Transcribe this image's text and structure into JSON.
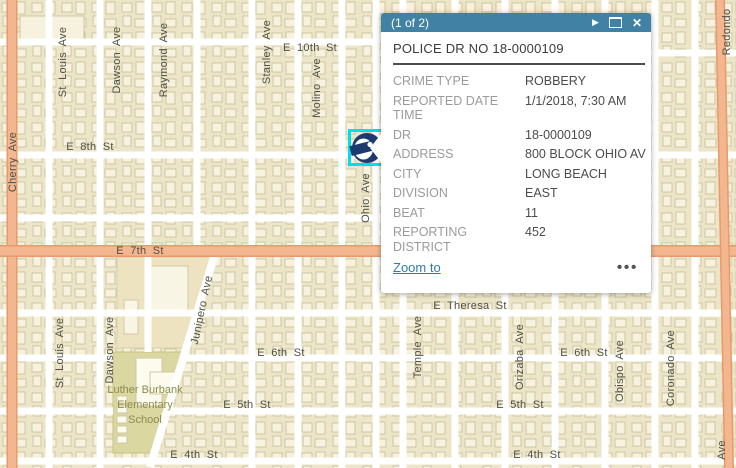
{
  "popup": {
    "pagination": "(1 of 2)",
    "title": "POLICE DR NO 18-0000109",
    "header_icons": {
      "next": "▶",
      "maximize": "maximize",
      "close": "✕"
    },
    "fields": [
      {
        "label_lines": [
          "CRIME TYPE"
        ],
        "value": "ROBBERY"
      },
      {
        "label_lines": [
          "REPORTED DATE",
          "TIME"
        ],
        "value": "1/1/2018, 7:30 AM"
      },
      {
        "label_lines": [
          "DR"
        ],
        "value": "18-0000109"
      },
      {
        "label_lines": [
          "ADDRESS"
        ],
        "value": "800 BLOCK OHIO AV"
      },
      {
        "label_lines": [
          "CITY"
        ],
        "value": "LONG BEACH"
      },
      {
        "label_lines": [
          "DIVISION"
        ],
        "value": "EAST"
      },
      {
        "label_lines": [
          "BEAT"
        ],
        "value": "11"
      },
      {
        "label_lines": [
          "REPORTING DISTRICT"
        ],
        "value": "452"
      }
    ],
    "footer": {
      "zoom_to": "Zoom to",
      "more": "•••"
    },
    "colors": {
      "header_bg": "#4182a4",
      "title": "#3b3b3b",
      "divider": "#4e4e4e",
      "label": "#9b9b9b",
      "value": "#4c4c4c",
      "link": "#2f7cab"
    }
  },
  "map": {
    "street_labels": [
      {
        "text": "Cherry Ave",
        "x": 13,
        "y": 162,
        "rot": -90
      },
      {
        "text": "St Louis Ave",
        "x": 63,
        "y": 62,
        "rot": -90
      },
      {
        "text": "Dawson Ave",
        "x": 117,
        "y": 60,
        "rot": -90
      },
      {
        "text": "Raymond Ave",
        "x": 164,
        "y": 60,
        "rot": -90
      },
      {
        "text": "Stanley Ave",
        "x": 267,
        "y": 52,
        "rot": -90
      },
      {
        "text": "Molino Ave",
        "x": 317,
        "y": 88,
        "rot": -90
      },
      {
        "text": "E 10th St",
        "x": 310,
        "y": 48,
        "rot": 0
      },
      {
        "text": "E 8th St",
        "x": 90,
        "y": 147,
        "rot": 0
      },
      {
        "text": "Ohio Ave",
        "x": 366,
        "y": 198,
        "rot": -90
      },
      {
        "text": "E 7th St",
        "x": 140,
        "y": 251,
        "rot": 0
      },
      {
        "text": "Junipero Ave",
        "x": 202,
        "y": 310,
        "rot": -78
      },
      {
        "text": "St Louis Ave",
        "x": 60,
        "y": 353,
        "rot": -90
      },
      {
        "text": "Dawson Ave",
        "x": 110,
        "y": 350,
        "rot": -90
      },
      {
        "text": "E Theresa St",
        "x": 470,
        "y": 306,
        "rot": 0
      },
      {
        "text": "Temple Ave",
        "x": 418,
        "y": 347,
        "rot": -90
      },
      {
        "text": "Orizaba Ave",
        "x": 520,
        "y": 357,
        "rot": -90
      },
      {
        "text": "E 6th St",
        "x": 281,
        "y": 353,
        "rot": 0
      },
      {
        "text": "E 6th St",
        "x": 584,
        "y": 353,
        "rot": 0
      },
      {
        "text": "Obispo Ave",
        "x": 620,
        "y": 371,
        "rot": -90
      },
      {
        "text": "Coronado Ave",
        "x": 671,
        "y": 368,
        "rot": -90
      },
      {
        "text": "E 5th St",
        "x": 247,
        "y": 405,
        "rot": 0
      },
      {
        "text": "E 5th St",
        "x": 520,
        "y": 405,
        "rot": 0
      },
      {
        "text": "E 4th St",
        "x": 194,
        "y": 455,
        "rot": 0
      },
      {
        "text": "E 4th St",
        "x": 537,
        "y": 455,
        "rot": 0
      },
      {
        "text": "Redondo",
        "x": 727,
        "y": 32,
        "rot": -90
      },
      {
        "text": "Ave",
        "x": 722,
        "y": 450,
        "rot": -90
      }
    ],
    "school": {
      "lines": [
        "Luther Burbank",
        "Elementary",
        "School"
      ],
      "x": 145,
      "y": 383
    },
    "marker_name": "robbery incident",
    "colors": {
      "base": "#f6f1dc",
      "block": "#ece5c7",
      "building_fill": "#f7f2dd",
      "building_stroke": "#ccc5a4",
      "street": "#ffffff",
      "major_fill": "#f4b68e",
      "major_edge": "#e59b6e",
      "school_fill": "#dbd7a1",
      "school_stroke": "#c7c37f",
      "school_text": "#8b8b49",
      "street_label": "#4f4f46",
      "marker": "#1c3a70",
      "selection": "#00dfe8"
    }
  }
}
